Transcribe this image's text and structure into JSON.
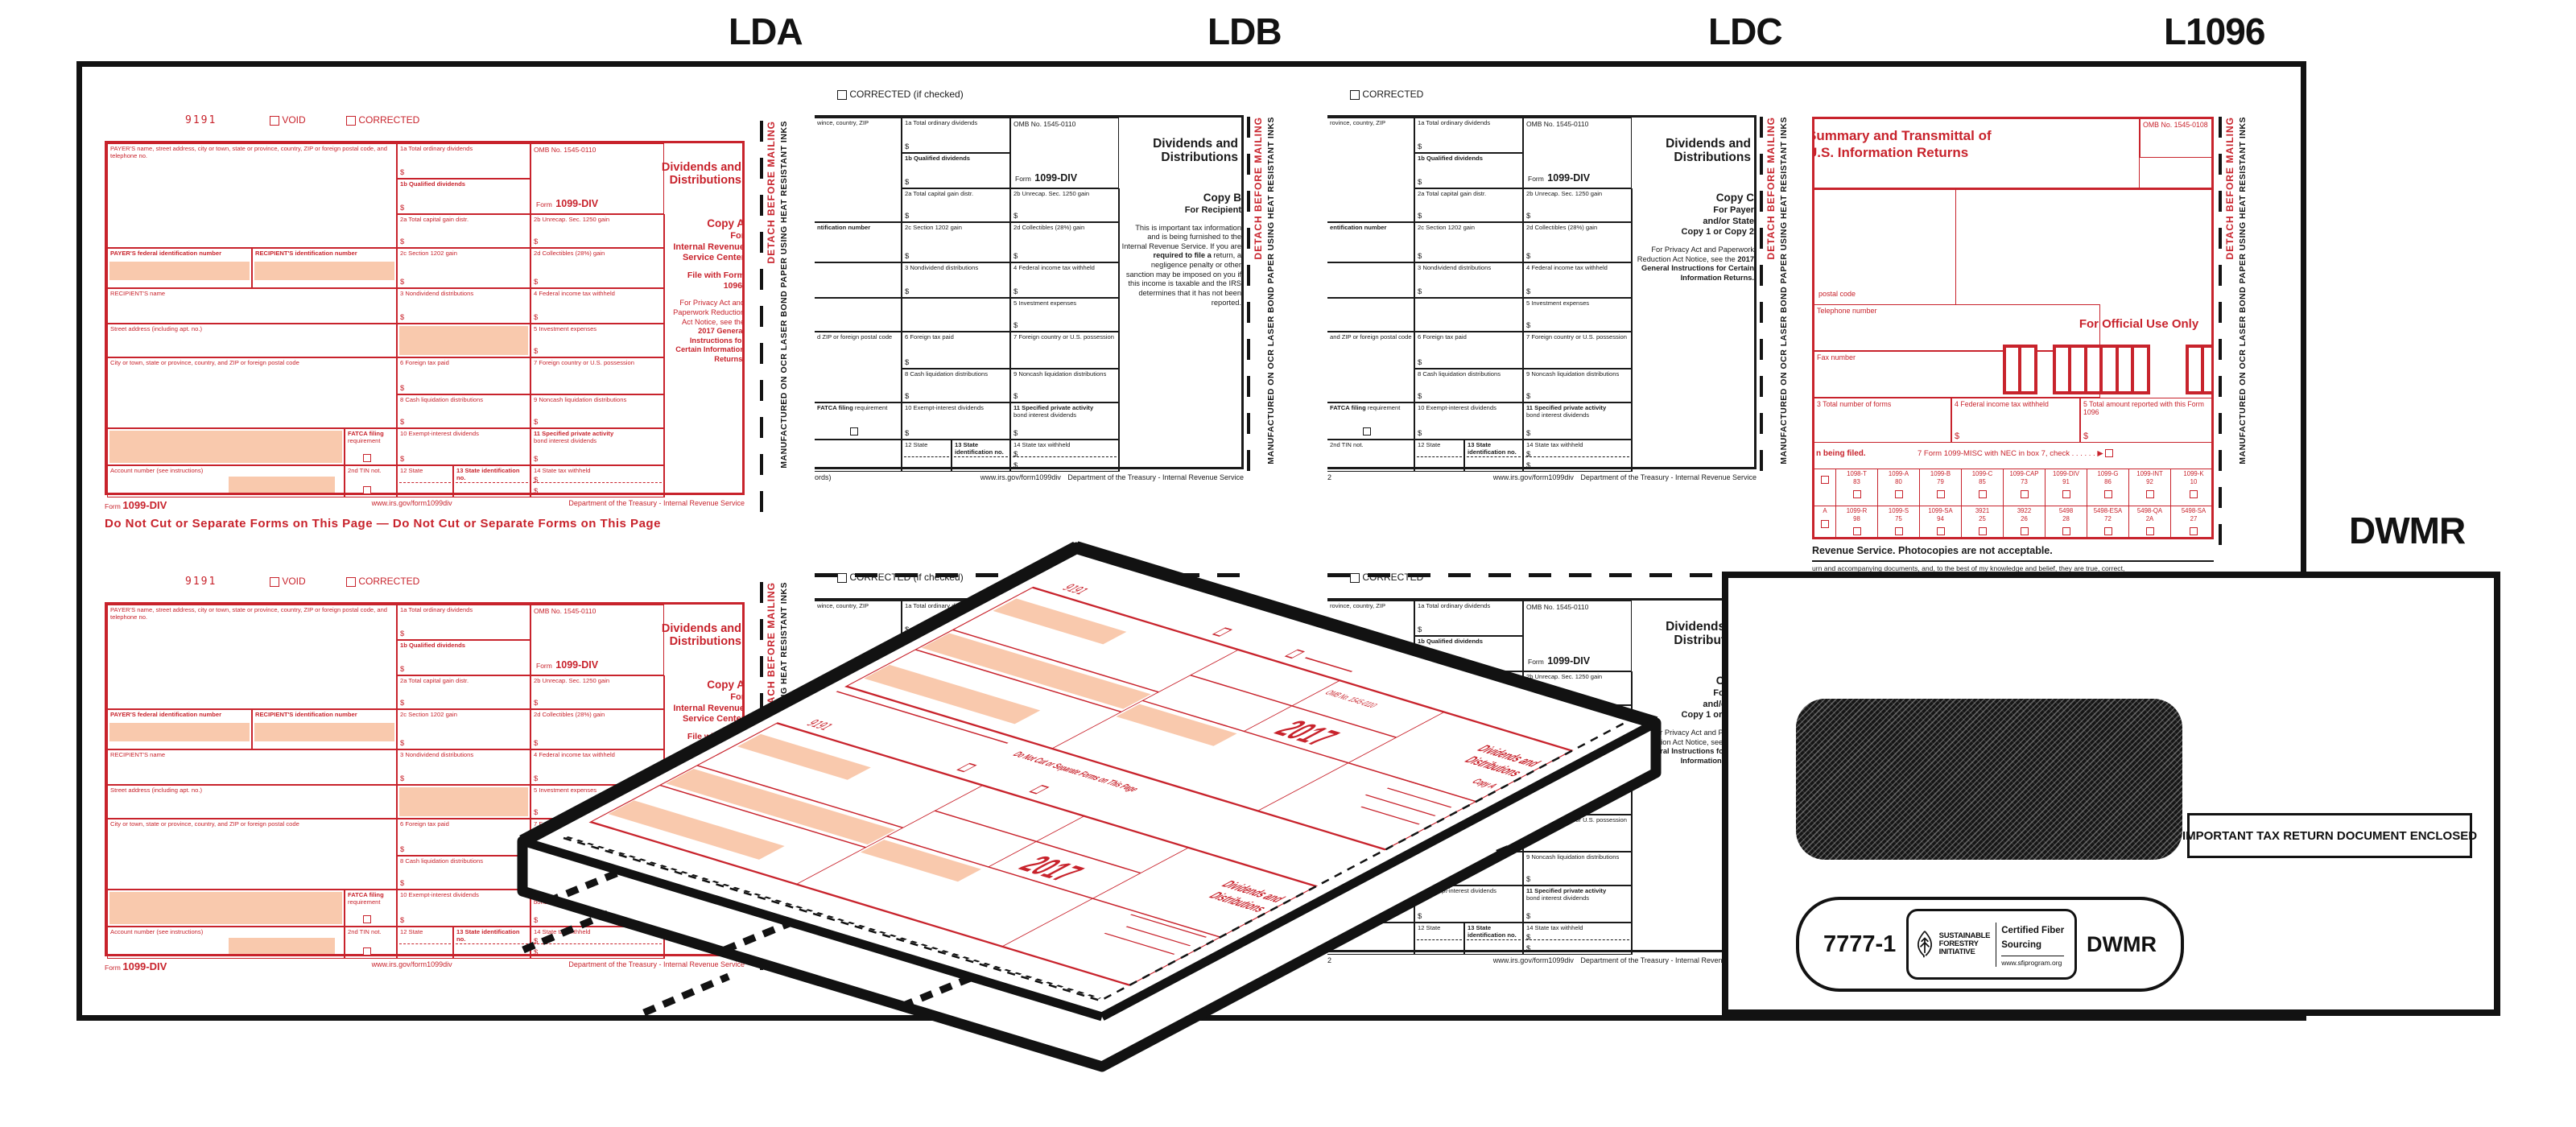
{
  "page_labels": {
    "lda": "LDA",
    "ldb": "LDB",
    "ldc": "LDC",
    "l1096": "L1096",
    "dwmr": "DWMR"
  },
  "glyphs": {
    "dollar": "$",
    "arrow": "▶",
    "dots": ".      .      .      .      .      ."
  },
  "strips": {
    "detach": "DETACH BEFORE MAILING",
    "mfg": "MANUFACTURED ON OCR LASER BOND PAPER USING HEAT RESISTANT INKS"
  },
  "forms": {
    "lda": {
      "code": "9191",
      "void_label": "VOID",
      "corrected": "CORRECTED",
      "payer_label": "PAYER'S name, street address, city or town, state or province, country, ZIP or foreign postal code, and telephone no.",
      "pid": "PAYER'S federal identification number",
      "rid": "RECIPIENT'S identification number",
      "rname": "RECIPIENT'S name",
      "street": "Street address (including apt. no.)",
      "city": "City or town, state or province, country, and ZIP or foreign postal code",
      "fatca1": "FATCA filing",
      "fatca2": "requirement",
      "account": "Account number (see instructions)",
      "tin": "2nd TIN not.",
      "b1a": "1a  Total ordinary dividends",
      "b1b": "1b  Qualified dividends",
      "omb": "OMB No. 1545-0110",
      "form_word": "Form",
      "form_name": "1099-DIV",
      "title": "Dividends and Distributions",
      "b2a": "2a  Total capital gain distr.",
      "b2b": "2b  Unrecap. Sec. 1250 gain",
      "b2c": "2c  Section 1202 gain",
      "b2d": "2d  Collectibles (28%) gain",
      "b3": "3  Nondividend distributions",
      "b4": "4  Federal income tax withheld",
      "b5": "5  Investment expenses",
      "b6": "6  Foreign tax paid",
      "b7": "7  Foreign country or U.S. possession",
      "b8": "8  Cash liquidation distributions",
      "b9": "9  Noncash liquidation distributions",
      "b10": "10 Exempt-interest dividends",
      "b11a": "11  Specified private activity",
      "b11b": "bond interest dividends",
      "b12": "12  State",
      "b13": "13  State identification no.",
      "b14": "14  State tax withheld",
      "copy": "Copy A",
      "for1": "For",
      "for2": "Internal Revenue",
      "for3": "Service Center",
      "file_with": "File with Form 1096.",
      "note_head": "For Privacy Act and Paperwork Reduction Act Notice, see the",
      "note_bold": "2017 General Instructions for Certain Information Returns.",
      "note_tail": "",
      "footer_url": "www.irs.gov/form1099div",
      "footer_dept": "Department of the Treasury - Internal Revenue Service",
      "donotcut": "Do Not Cut or Separate Forms on This Page   —   Do Not Cut or Separate Forms on This Page"
    },
    "ldb": {
      "corrected": "CORRECTED (if checked)",
      "payer_label": "wince, country, ZIP",
      "pid": "ntification number",
      "city": "d ZIP or foreign postal code",
      "fatca1": "FATCA filing",
      "fatca2": "requirement",
      "tin": "",
      "b1a": "1a  Total ordinary dividends",
      "b1b": "1b  Qualified dividends",
      "omb": "OMB No. 1545-0110",
      "form_word": "Form",
      "form_name": "1099-DIV",
      "title": "Dividends and Distributions",
      "b2a": "2a  Total capital gain distr.",
      "b2b": "2b  Unrecap. Sec. 1250 gain",
      "b2c": "2c  Section 1202 gain",
      "b2d": "2d  Collectibles (28%) gain",
      "b3": "3  Nondividend distributions",
      "b4": "4  Federal income tax withheld",
      "b5": "5  Investment expenses",
      "b6": "6  Foreign tax paid",
      "b7": "7  Foreign country or U.S. possession",
      "b8": "8  Cash liquidation distributions",
      "b9": "9  Noncash liquidation distributions",
      "b10": "10 Exempt-interest dividends",
      "b11a": "11  Specified private activity",
      "b11b": "bond interest dividends",
      "b12": "12  State",
      "b13": "13  State identification no.",
      "b14": "14  State tax withheld",
      "copy": "Copy B",
      "for1": "For Recipient",
      "for2": "",
      "for3": "",
      "file_with": "",
      "note_head": "This is important tax information and is being furnished to the Internal Revenue Service. If you are",
      "note_bold": "required to file a",
      "note_tail": "return, a negligence penalty or other sanction may be imposed on you if this income is taxable and the IRS determines that it has not been reported.",
      "footer_left": "ords)",
      "footer_url": "www.irs.gov/form1099div",
      "footer_dept": "Department of the Treasury - Internal Revenue Service"
    },
    "ldc": {
      "corrected": "CORRECTED",
      "payer_label": "rovince, country, ZIP",
      "pid": "entification number",
      "city": "and ZIP or foreign postal code",
      "fatca1": "FATCA filing",
      "fatca2": "requirement",
      "tin": "2nd TIN not.",
      "b1a": "1a  Total ordinary dividends",
      "b1b": "1b  Qualified dividends",
      "omb": "OMB No. 1545-0110",
      "form_word": "Form",
      "form_name": "1099-DIV",
      "title": "Dividends and Distributions",
      "b2a": "2a  Total capital gain distr.",
      "b2b": "2b  Unrecap. Sec. 1250 gain",
      "b2c": "2c  Section 1202 gain",
      "b2d": "2d  Collectibles (28%) gain",
      "b3": "3  Nondividend distributions",
      "b4": "4  Federal income tax withheld",
      "b5": "5  Investment expenses",
      "b6": "6  Foreign tax paid",
      "b7": "7  Foreign country or U.S. possession",
      "b8": "8  Cash liquidation distributions",
      "b9": "9  Noncash liquidation distributions",
      "b10": "10 Exempt-interest dividends",
      "b11a": "11  Specified private activity",
      "b11b": "bond interest dividends",
      "b12": "12  State",
      "b13": "13  State identification no.",
      "b14": "14  State tax withheld",
      "copy": "Copy C",
      "for1": "For Payer",
      "for2": "and/or State",
      "for3": "Copy 1 or Copy 2",
      "file_with": "",
      "note_head": "For Privacy Act and Paperwork Reduction Act Notice, see the",
      "note_bold": "2017 General Instructions for Certain Information Returns.",
      "note_tail": "",
      "footer_left": "2",
      "footer_url": "www.irs.gov/form1099div",
      "footer_dept": "Department of the Treasury - Internal Revenue Service"
    }
  },
  "f1096": {
    "title1": "Summary and Transmittal of",
    "title2": "U.S. Information Returns",
    "omb": "OMB No. 1545-0108",
    "postal": "postal code",
    "tel": "Telephone number",
    "fax": "Fax number",
    "official": "For Official Use Only",
    "b3": "3 Total number of forms",
    "b4": "4 Federal income tax withheld",
    "b5": "5 Total amount reported with this Form 1096",
    "being_filed": "n being filed.",
    "b7": "7 Form 1099-MISC with NEC in box 7, check",
    "r2lead": "A",
    "r1": [
      {
        "n": "1098-T",
        "c": "83"
      },
      {
        "n": "1099-A",
        "c": "80"
      },
      {
        "n": "1099-B",
        "c": "79"
      },
      {
        "n": "1099-C",
        "c": "85"
      },
      {
        "n": "1099-CAP",
        "c": "73"
      },
      {
        "n": "1099-DIV",
        "c": "91"
      },
      {
        "n": "1099-G",
        "c": "86"
      },
      {
        "n": "1099-INT",
        "c": "92"
      },
      {
        "n": "1099-K",
        "c": "10"
      }
    ],
    "r2": [
      {
        "n": "1099-R",
        "c": "98"
      },
      {
        "n": "1099-S",
        "c": "75"
      },
      {
        "n": "1099-SA",
        "c": "94"
      },
      {
        "n": "3921",
        "c": "25"
      },
      {
        "n": "3922",
        "c": "26"
      },
      {
        "n": "5498",
        "c": "28"
      },
      {
        "n": "5498-ESA",
        "c": "72"
      },
      {
        "n": "5498-QA",
        "c": "2A"
      },
      {
        "n": "5498-SA",
        "c": "27"
      }
    ],
    "foot1": "Revenue Service. Photocopies are not acceptable.",
    "foot2": "urn and accompanying documents, and, to the best of my knowledge and belief, they are true, correct,"
  },
  "envelope": {
    "important": "IMPORTANT TAX RETURN DOCUMENT ENCLOSED",
    "num": "7777-1",
    "code": "DWMR",
    "sfi1": "SUSTAINABLE",
    "sfi2": "FORESTRY",
    "sfi3": "INITIATIVE",
    "cert1": "Certified Fiber",
    "cert2": "Sourcing",
    "url": "www.sfiprogram.org"
  },
  "stack": {
    "code": "9191",
    "year": "2017",
    "title1": "Dividends and",
    "title2": "Distributions",
    "copy": "Copy A",
    "cut": "Do Not Cut or Separate Forms on This Page"
  },
  "colors": {
    "red_ink": "#c8232c",
    "peach": "#f9c9ad",
    "black_ink": "#121212"
  }
}
